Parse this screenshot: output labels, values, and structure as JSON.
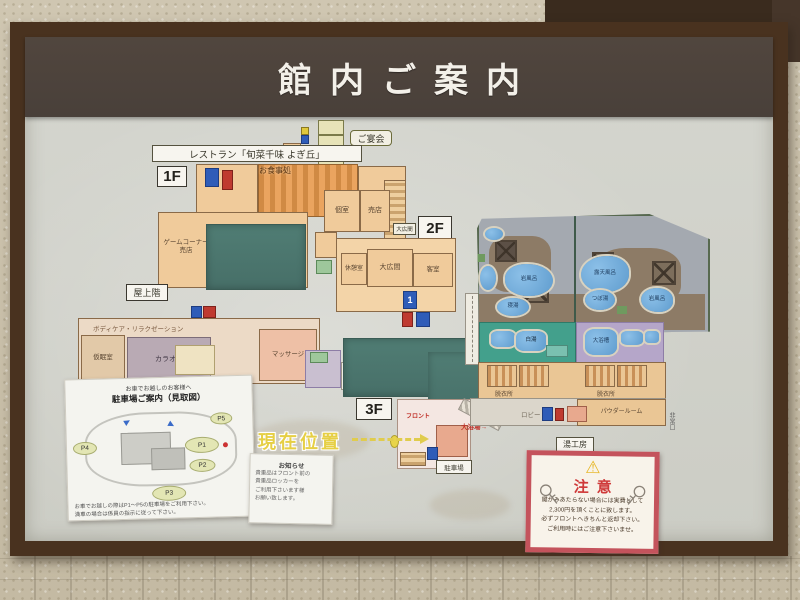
{
  "sign": {
    "title": "館内ご案内"
  },
  "floors": {
    "f1": "1F",
    "f2": "2F",
    "f3": "3F"
  },
  "labels": {
    "restaurant": "レストラン「旬菜千味 よぎ丘」",
    "banquet": "ご宴会",
    "rooftop": "屋上階",
    "hall_small": "大広間",
    "current_location": "現在位置",
    "to_bath": "大浴場→",
    "front_desk": "フロント",
    "parking_box": "駐車場",
    "yukobo": "湯工房",
    "emergency_exit": "非常口",
    "lobby": "ロビー",
    "powder": "パウダールーム"
  },
  "rooms": {
    "game_corner": "ゲームコーナー",
    "shop": "売店",
    "dining": "お食事処",
    "private_room": "個室",
    "shop2": "売店",
    "rest_room": "休憩室",
    "hall": "大広間",
    "guest_room": "客室",
    "karaoke": "カラオケ",
    "massage": "マッサージ",
    "nap_room": "仮眠室",
    "relaxation": "ボディケア・リラクゼーション",
    "dressing_m": "脱衣所",
    "dressing_f": "脱衣所",
    "open_air_bath": "露天風呂",
    "rock_bath": "岩風呂",
    "rock_bath2": "岩風呂",
    "lying_bath": "寝湯",
    "pot_bath": "つぼ湯",
    "white_bath": "白湯",
    "main_bath": "大浴槽"
  },
  "elevator": {
    "number": "1"
  },
  "parking_map": {
    "heading_small": "お車でお越しのお客様へ",
    "heading": "駐車場ご案内（見取図）",
    "lots": [
      "P1",
      "P2",
      "P3",
      "P4",
      "P5"
    ],
    "note1": "お車でお越しの際はP1〜P5の駐車場をご利用下さい。",
    "note2": "満車の場合は係員の指示に従って下さい。"
  },
  "notice": {
    "title": "お知らせ",
    "line1": "貴重品はフロント前の",
    "line2": "貴重品ロッカーを",
    "line3": "ご利用下さいます様",
    "line4": "お願い致します。"
  },
  "caution": {
    "title": "注意",
    "warning_glyph": "⚠",
    "line1": "鍵がみあたらない場合には実費として",
    "line2": "2,300円を頂くことに致します。",
    "line3": "必ずフロントへきちんと返却下さい。",
    "line4": "ご利用時にはご注意下さいませ。"
  }
}
